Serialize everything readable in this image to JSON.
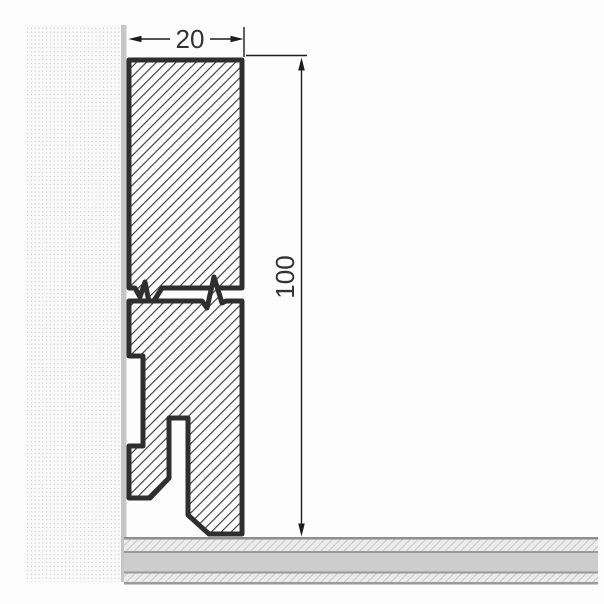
{
  "drawing": {
    "title": "skirting-board-cross-section",
    "dimensions": {
      "width": {
        "label": "20"
      },
      "height": {
        "label": "100"
      }
    },
    "colors": {
      "outline": "#2f2f2f",
      "hatch_line": "#3d3d3d",
      "dimension_line": "#1c1c1c",
      "label_text": "#333333",
      "wall_dot": "#c9c9c9",
      "wall_edge_strip": "#c6c6c6",
      "floor_band_solid": "#cdcdcd",
      "floor_band_hatched_bg": "#ebebeb",
      "floor_band_hatch_line": "#c6c6c6",
      "floor_separator_line": "#9a9a9a"
    },
    "parts": {
      "wall": "wall-stipple-texture",
      "wall_edge": "wall-surface-strip",
      "floor": "floor-layers",
      "profile_upper": "profile-upper-section",
      "profile_lower": "profile-lower-section",
      "break": "break-line-gap",
      "recess": "rear-mounting-recess",
      "slot": "bottom-cable-slot"
    }
  }
}
